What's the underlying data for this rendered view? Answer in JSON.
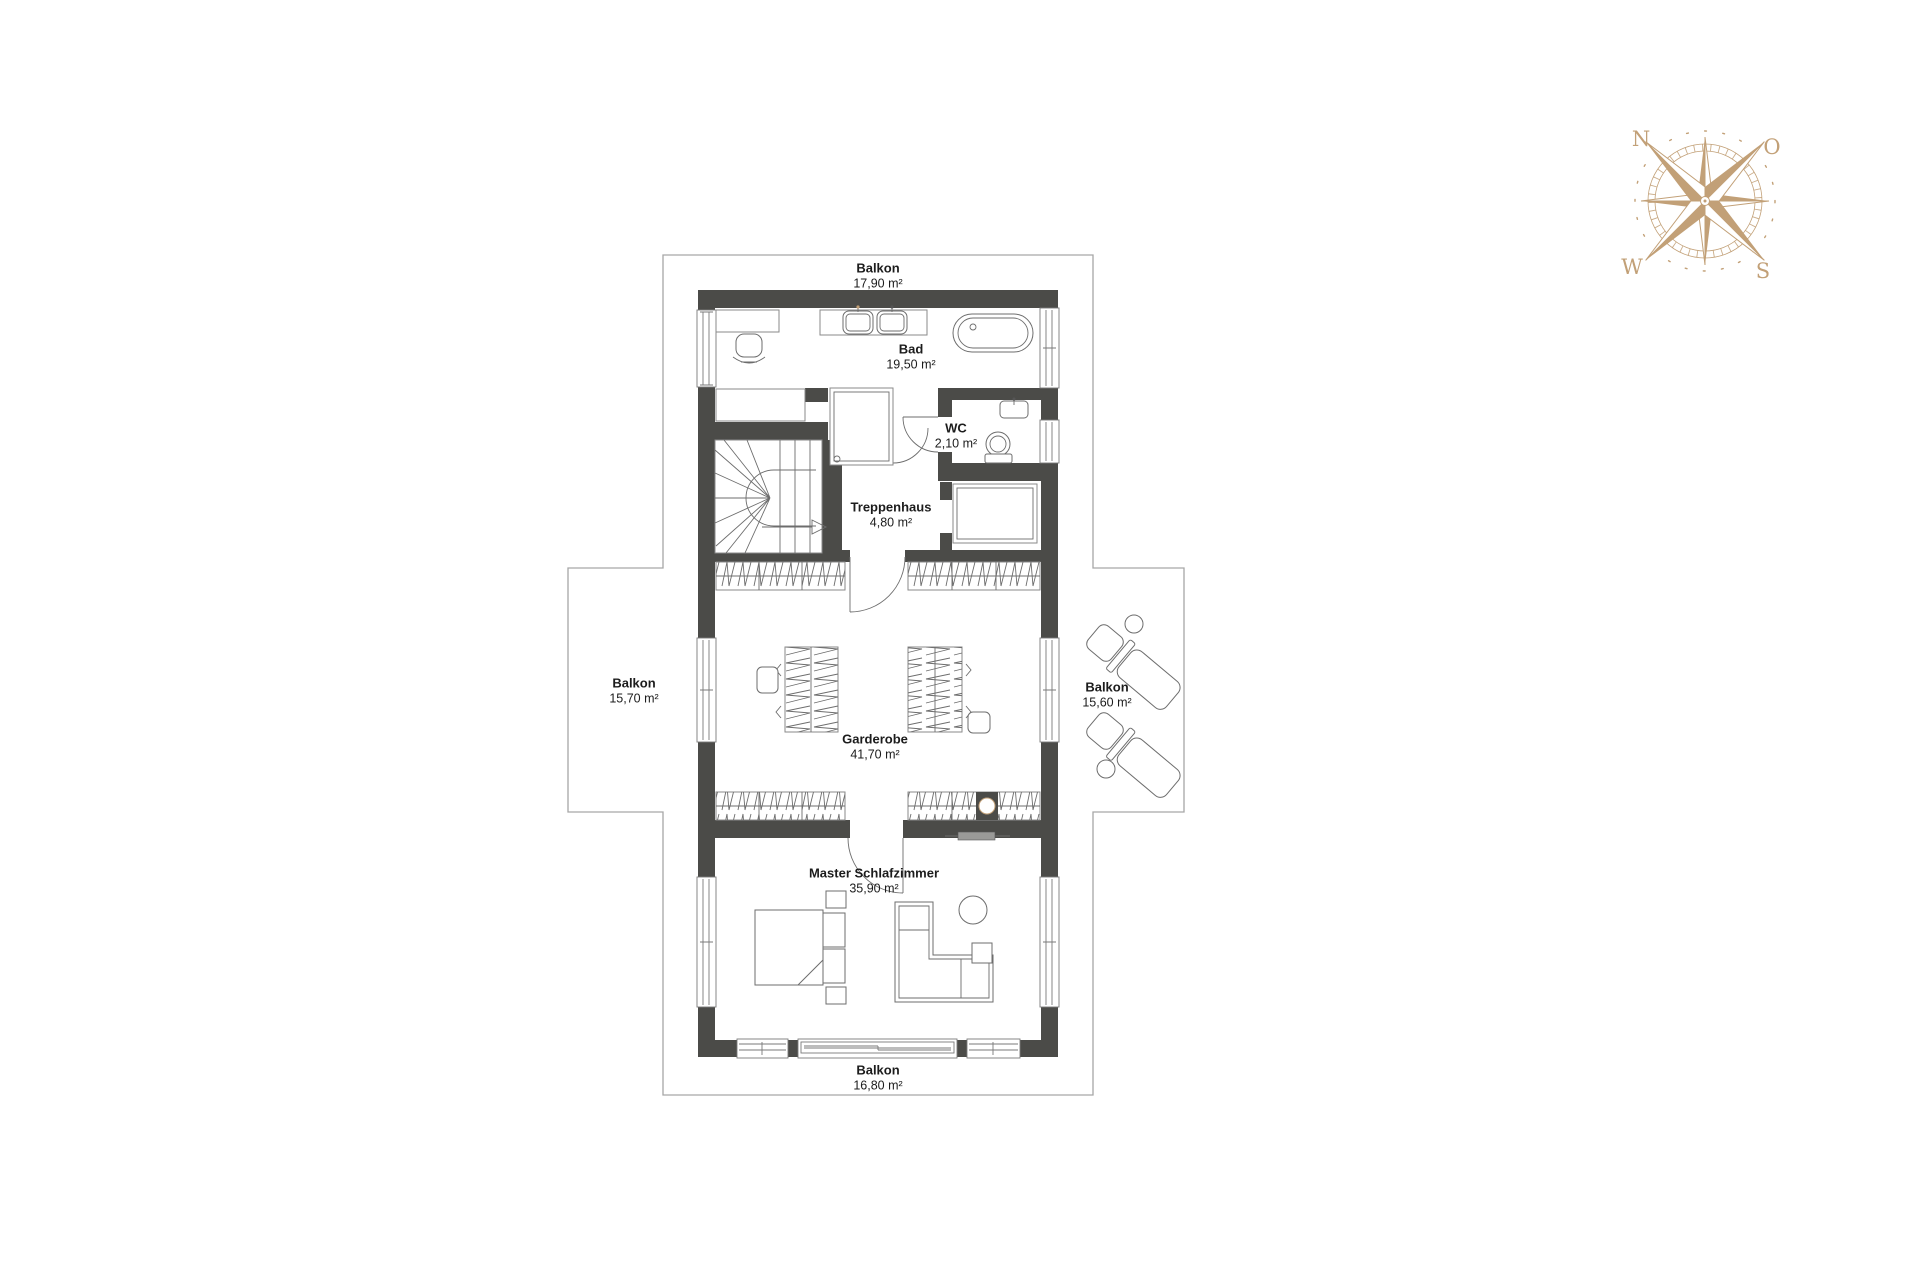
{
  "compass": {
    "n": "N",
    "o": "O",
    "w": "W",
    "s": "S"
  },
  "rooms": [
    {
      "name": "Balkon",
      "area": "17,90 m²"
    },
    {
      "name": "Bad",
      "area": "19,50 m²"
    },
    {
      "name": "WC",
      "area": "2,10 m²"
    },
    {
      "name": "Treppenhaus",
      "area": "4,80 m²"
    },
    {
      "name": "Balkon",
      "area": "15,70 m²"
    },
    {
      "name": "Balkon",
      "area": "15,60 m²"
    },
    {
      "name": "Garderobe",
      "area": "41,70 m²"
    },
    {
      "name": "Master Schlafzimmer",
      "area": "35,90 m²"
    },
    {
      "name": "Balkon",
      "area": "16,80 m²"
    }
  ],
  "colors": {
    "wall": "#4b4b48",
    "line": "#8a8a8a",
    "boundary": "#a6a6a6",
    "compass": "#c2a077",
    "text": "#1c1c1c"
  },
  "icons": {
    "compass-rose": "8-point compass rose, N top-left, O top-right, S bottom-right, W bottom-left"
  }
}
